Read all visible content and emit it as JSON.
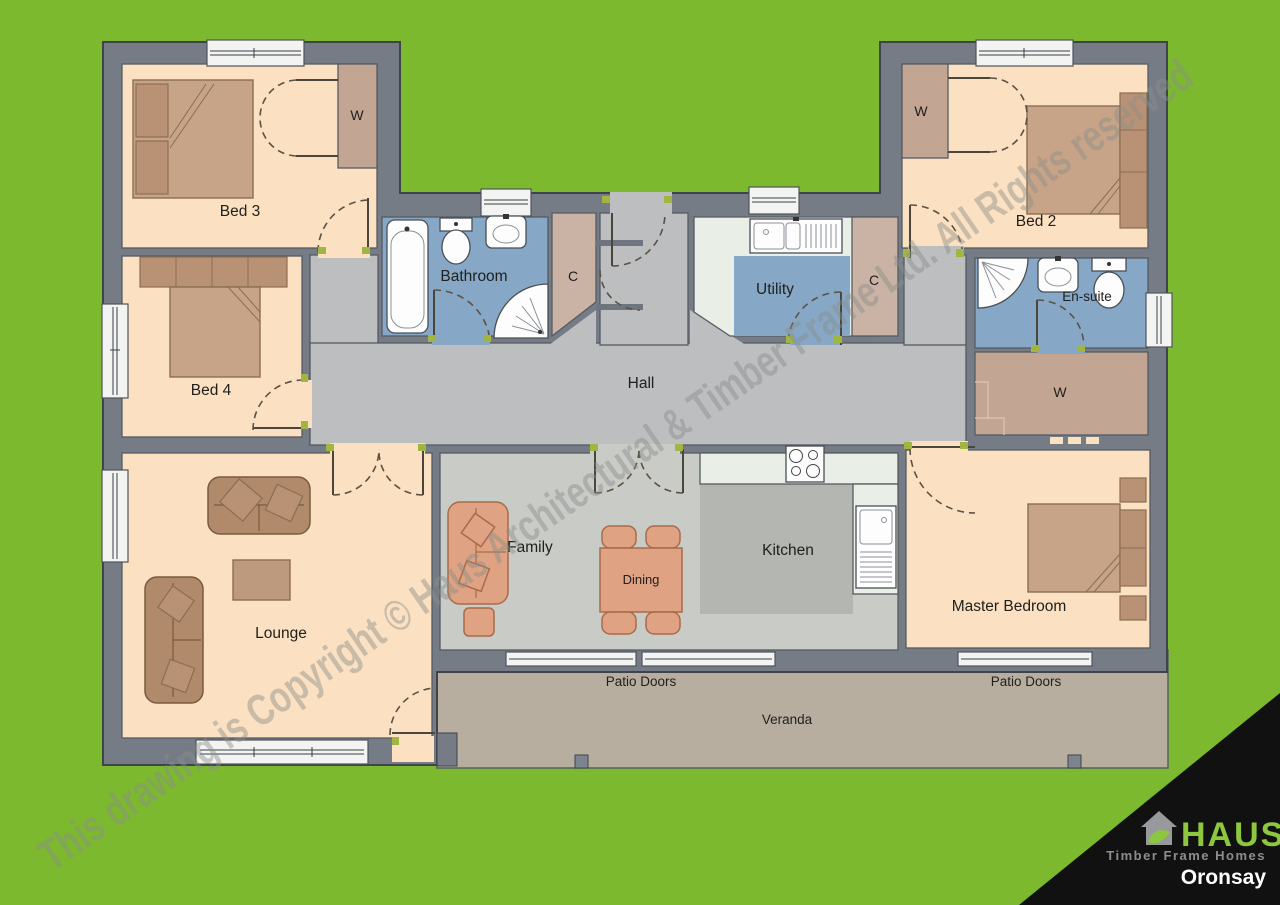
{
  "plan": {
    "name": "Oronsay",
    "watermark": "This drawing is Copyright © Haus Architectural & Timber Frame Ltd. All Rights reserved",
    "brand": {
      "name": "HAUS",
      "tagline": "Timber Frame Homes"
    },
    "rooms": {
      "bed2": "Bed 2",
      "bed3": "Bed 3",
      "bed4": "Bed 4",
      "master": "Master Bedroom",
      "lounge": "Lounge",
      "family": "Family",
      "dining": "Dining",
      "kitchen": "Kitchen",
      "hall": "Hall",
      "bathroom": "Bathroom",
      "ensuite": "En-suite",
      "utility": "Utility",
      "wardrobe": "W",
      "cupboard": "C",
      "patio_doors": "Patio Doors",
      "veranda": "Veranda"
    },
    "colors": {
      "site_green": "#7cb92e",
      "wall": "#767c85",
      "room_peach": "#fce0c2",
      "hall_grey": "#bcbec0",
      "wet_room_blue": "#86a8c6",
      "cupboard_tan": "#cab3a5",
      "closet_brown": "#c2a592",
      "veranda_taupe": "#b7ae9f",
      "worktop": "#e9efe7",
      "kitchen_floor": "#b4b6b2",
      "family_floor": "#c9cbc7",
      "logo_green": "#8dc63f",
      "logo_black": "#111111"
    }
  }
}
